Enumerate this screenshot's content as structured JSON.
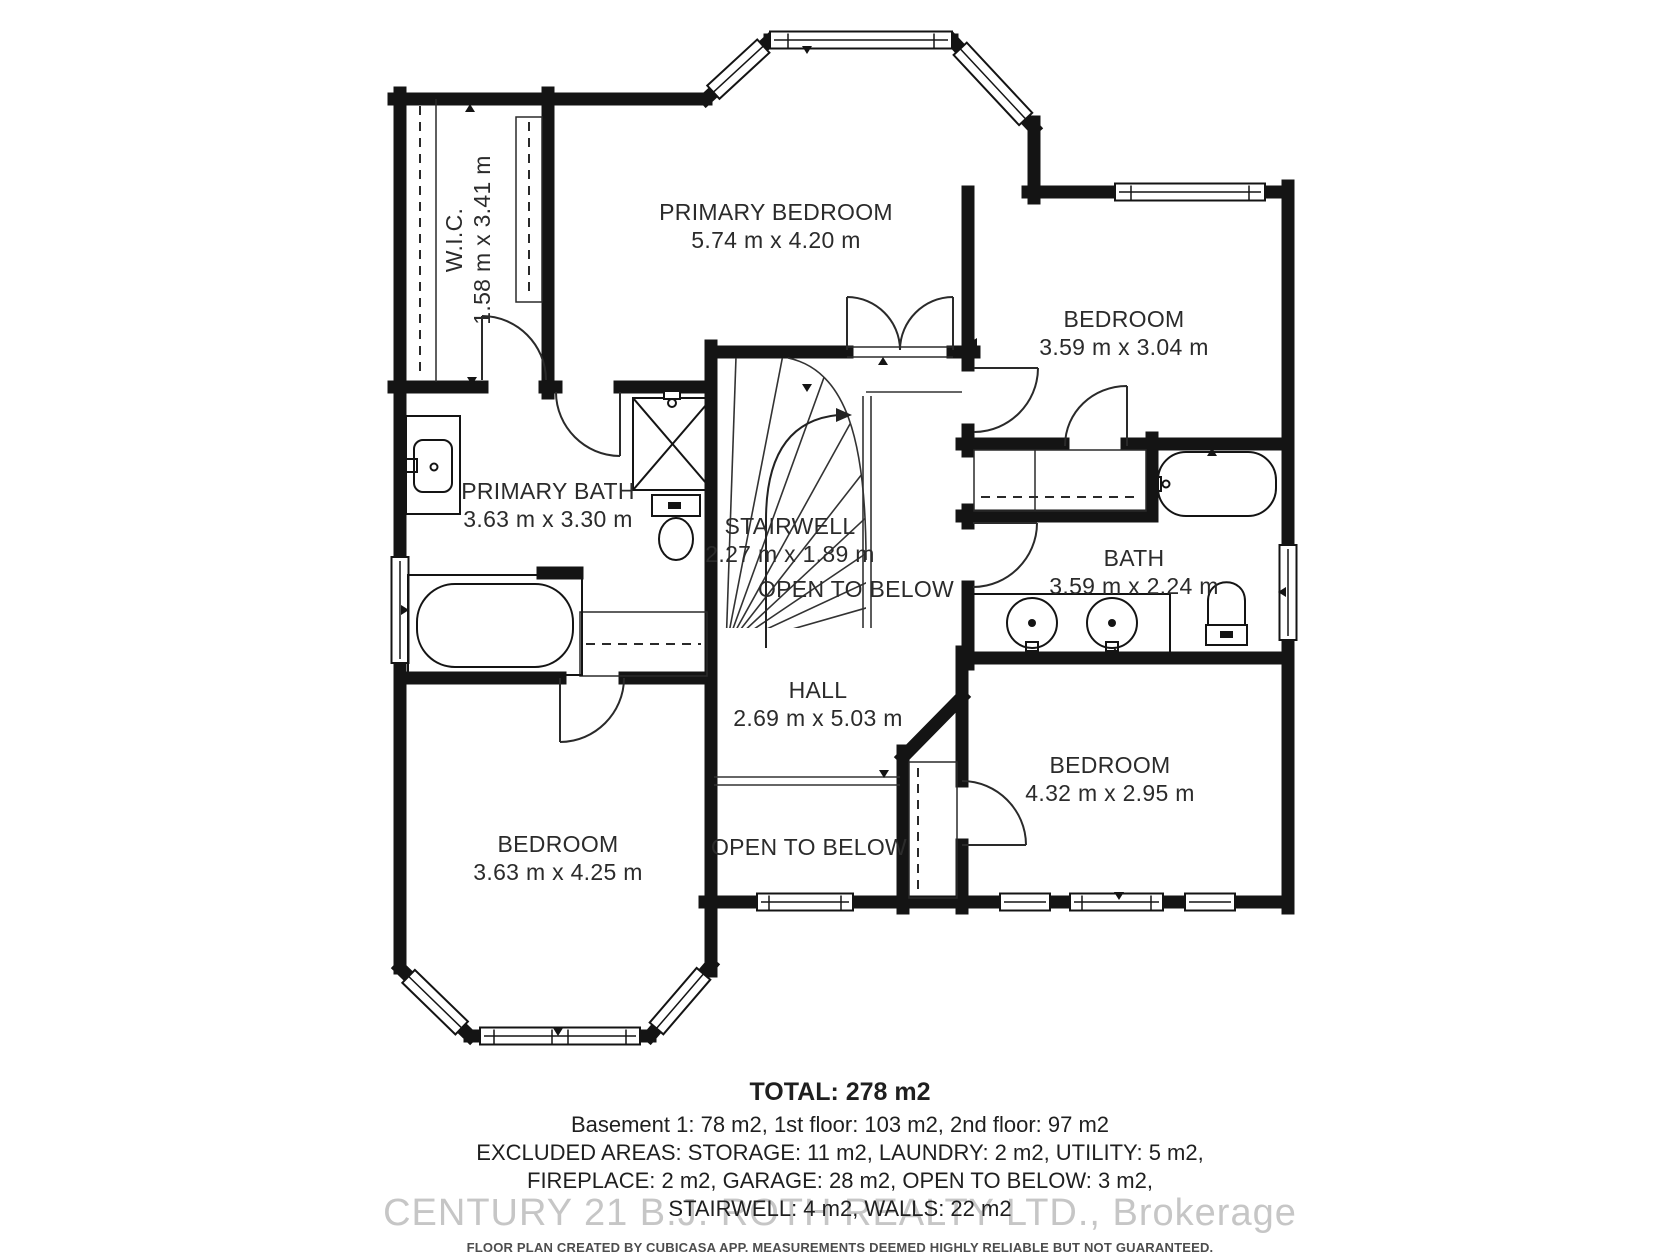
{
  "plan": {
    "rooms": {
      "wic": {
        "name": "W.I.C.",
        "dims": "1.58 m x 3.41 m"
      },
      "primary_bedroom": {
        "name": "PRIMARY BEDROOM",
        "dims": "5.74 m x 4.20 m"
      },
      "bedroom_top_right": {
        "name": "BEDROOM",
        "dims": "3.59 m x 3.04 m"
      },
      "primary_bath": {
        "name": "PRIMARY BATH",
        "dims": "3.63 m x 3.30 m"
      },
      "stairwell": {
        "name": "STAIRWELL",
        "dims": "2.27 m x 1.89 m"
      },
      "bath": {
        "name": "BATH",
        "dims": "3.59 m x 2.24 m"
      },
      "hall": {
        "name": "HALL",
        "dims": "2.69 m x 5.03 m"
      },
      "bedroom_bottom_left": {
        "name": "BEDROOM",
        "dims": "3.63 m x 4.25 m"
      },
      "bedroom_bottom_right": {
        "name": "BEDROOM",
        "dims": "4.32 m x 2.95 m"
      }
    },
    "annotations": {
      "open_to_below_upper": "OPEN TO BELOW",
      "open_to_below_lower": "OPEN TO BELOW"
    }
  },
  "footer": {
    "total": "TOTAL: 278 m2",
    "floors_line": "Basement 1: 78 m2, 1st floor: 103 m2, 2nd floor: 97 m2",
    "excluded_line1": "EXCLUDED AREAS: STORAGE: 11 m2, LAUNDRY: 2 m2, UTILITY: 5 m2,",
    "excluded_line2": "FIREPLACE: 2 m2, GARAGE: 28 m2, OPEN TO BELOW: 3 m2,",
    "excluded_line3": "STAIRWELL: 4 m2, WALLS: 22 m2",
    "watermark": "CENTURY 21 B.J. ROTH REALTY LTD.,  Brokerage",
    "disclaimer": "FLOOR PLAN CREATED BY CUBICASA APP. MEASUREMENTS DEEMED HIGHLY RELIABLE BUT NOT GUARANTEED."
  },
  "colors": {
    "wall": "#141414",
    "label": "#2b2b2b",
    "watermark": "#c6c6c6"
  }
}
